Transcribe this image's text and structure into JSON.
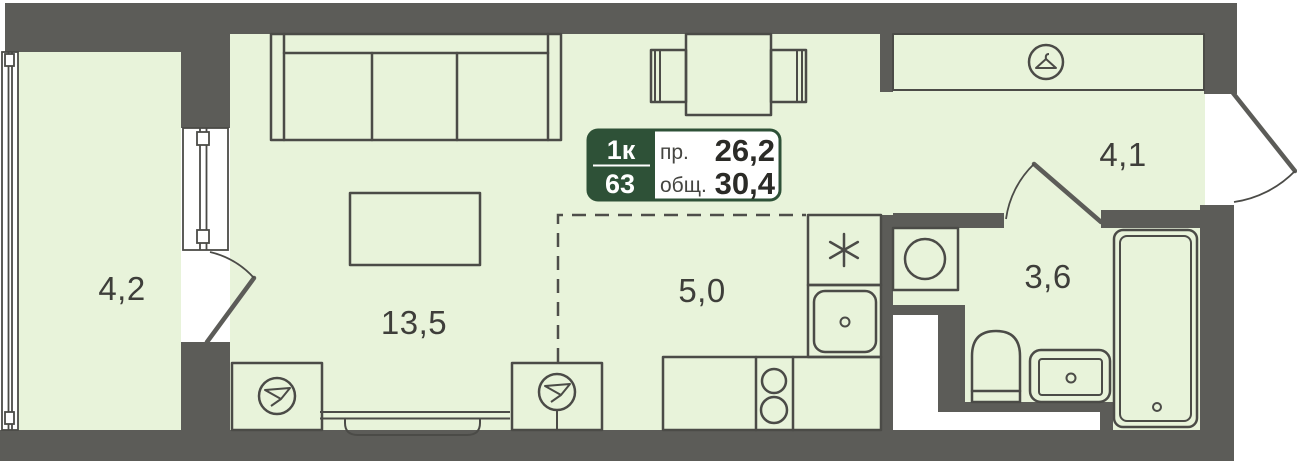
{
  "colors": {
    "floor": "#e8f3da",
    "wall": "#5c5c58",
    "line": "#4b4b47",
    "accent-green": "#2e5137",
    "label-text": "#3e3e3a",
    "badge-number-text": "#2b2b27",
    "badge-small-text": "#454541",
    "white": "#ffffff"
  },
  "badge": {
    "unit_type": "1к",
    "unit_number": "63",
    "reduced_area_label": "пр.",
    "reduced_area_value": "26,2",
    "total_area_label": "общ.",
    "total_area_value": "30,4"
  },
  "rooms": [
    {
      "name": "balcony",
      "area": "4,2"
    },
    {
      "name": "living-room",
      "area": "13,5"
    },
    {
      "name": "kitchen-niche",
      "area": "5,0"
    },
    {
      "name": "bathroom",
      "area": "3,6"
    },
    {
      "name": "hallway",
      "area": "4,1"
    }
  ],
  "icons": {
    "wardrobe": "hanger-icon",
    "fridge": "snowflake-asterisk-icon",
    "cabinets": "funnel-circle-icon",
    "washing_machine": "circle-icon"
  },
  "furniture": [
    "sofa",
    "dining-table",
    "dining-chairs",
    "coffee-table",
    "kitchen-counter",
    "stove",
    "kitchen-sink",
    "fridge",
    "wardrobe",
    "washing-machine",
    "toilet",
    "bathroom-sink",
    "bathtub"
  ]
}
